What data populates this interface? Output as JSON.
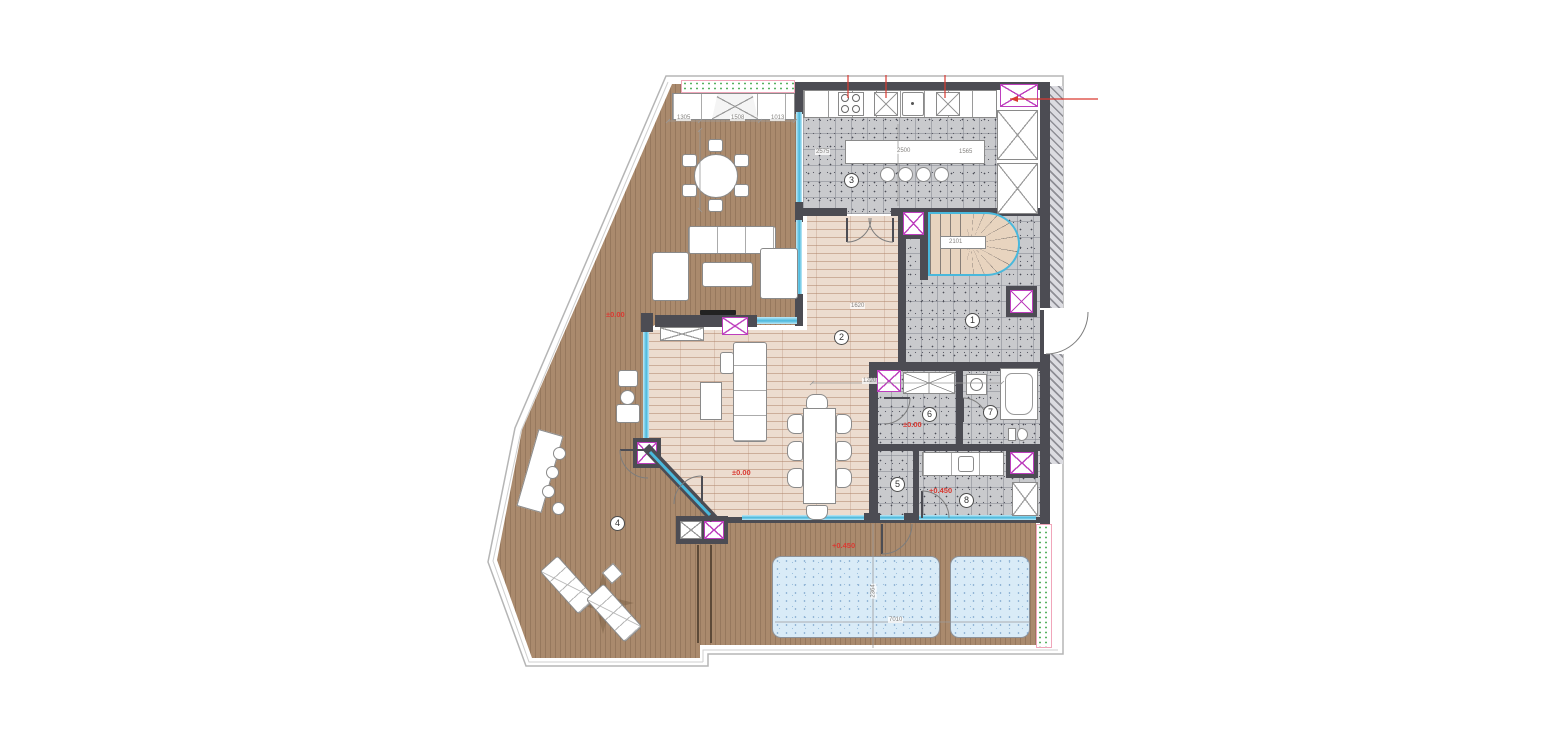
{
  "plan_title": "penthouse-floor-plan",
  "rooms": {
    "r1": "1",
    "r2": "2",
    "r3": "3",
    "r4": "4",
    "r5": "5",
    "r6": "6",
    "r7": "7",
    "r8": "8"
  },
  "levels": {
    "terrace": "±0.00",
    "living": "±0.00",
    "hall6": "±0.00",
    "room8": "+0.450",
    "pool_deck": "+0.450"
  },
  "dims": {
    "island": "2500",
    "kitchen_left": "2575",
    "kitchen_right": "1565",
    "living_width": "1220",
    "living_side": "1620",
    "stair": "2101",
    "pool_width": "7010",
    "pool_depth": "2364",
    "terrace_a": "1305",
    "terrace_b": "1508",
    "terrace_c": "1013"
  },
  "colors": {
    "deck": "#aa8a6d",
    "tile": "#c9cacd",
    "plank": "#ecdccf",
    "wall": "#4c4c53",
    "glazing": "#49b8dc",
    "shaft_magenta": "#bd3ebd",
    "accent_red": "#d93a32",
    "pool": "#d9ebf7",
    "planter_pink": "#f0a6ba",
    "planter_green": "#57b261",
    "stair_wood": "#e8d4bf"
  }
}
